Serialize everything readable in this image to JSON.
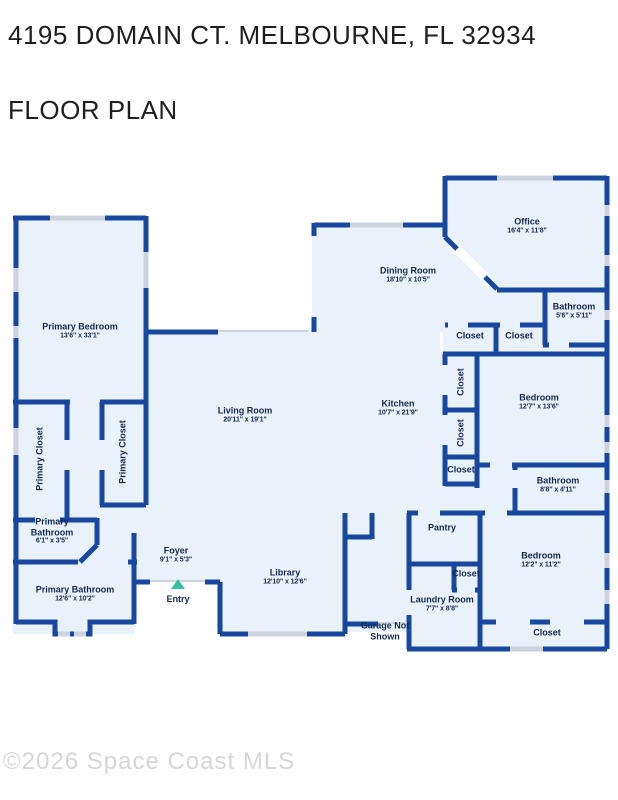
{
  "page": {
    "address_title": "4195 DOMAIN CT. MELBOURNE, FL 32934",
    "subtitle": "FLOOR PLAN",
    "watermark": "©2026 Space Coast MLS"
  },
  "floorplan": {
    "entry_label": "Entry",
    "garage_note": "Garage Not Shown",
    "colors": {
      "wall": "#17479e",
      "room_fill": "#e9f2fb",
      "window": "#ccd3dc",
      "label": "#14284b",
      "entry": "#35c0a2"
    },
    "rooms": [
      {
        "name": "Primary Bedroom",
        "dims": "13'6\" x 33'1\"",
        "x": 80,
        "y": 331
      },
      {
        "name": "Primary Closet",
        "dims": "",
        "x": 40,
        "y": 459,
        "vertical": true
      },
      {
        "name": "Primary Closet",
        "dims": "",
        "x": 123,
        "y": 452,
        "vertical": true
      },
      {
        "name": "Primary Bathroom",
        "dims": "6'1\" x 3'5\"",
        "x": 52,
        "y": 531,
        "wrap": true,
        "w": 58
      },
      {
        "name": "Primary Bathroom",
        "dims": "12'6\" x 10'2\"",
        "x": 75,
        "y": 594
      },
      {
        "name": "Foyer",
        "dims": "9'1\" x 5'3\"",
        "x": 176,
        "y": 555
      },
      {
        "name": "Living Room",
        "dims": "20'11\" x 19'1\"",
        "x": 245,
        "y": 415
      },
      {
        "name": "Library",
        "dims": "12'10\" x 12'6\"",
        "x": 285,
        "y": 577
      },
      {
        "name": "Dining Room",
        "dims": "18'10\" x 10'5\"",
        "x": 408,
        "y": 275
      },
      {
        "name": "Kitchen",
        "dims": "10'7\" x 21'9\"",
        "x": 398,
        "y": 408
      },
      {
        "name": "Office",
        "dims": "16'4\" x 11'8\"",
        "x": 527,
        "y": 226
      },
      {
        "name": "Bathroom",
        "dims": "5'6\" x 5'11\"",
        "x": 574,
        "y": 311
      },
      {
        "name": "Closet",
        "dims": "",
        "x": 470,
        "y": 336
      },
      {
        "name": "Closet",
        "dims": "",
        "x": 519,
        "y": 336
      },
      {
        "name": "Closet",
        "dims": "",
        "x": 461,
        "y": 382,
        "vertical": true
      },
      {
        "name": "Closet",
        "dims": "",
        "x": 461,
        "y": 433,
        "vertical": true
      },
      {
        "name": "Closet",
        "dims": "",
        "x": 461,
        "y": 470
      },
      {
        "name": "Bedroom",
        "dims": "12'7\" x 13'6\"",
        "x": 539,
        "y": 402
      },
      {
        "name": "Bathroom",
        "dims": "8'8\" x 4'11\"",
        "x": 558,
        "y": 485
      },
      {
        "name": "Pantry",
        "dims": "",
        "x": 442,
        "y": 528
      },
      {
        "name": "Closet",
        "dims": "",
        "x": 466,
        "y": 574
      },
      {
        "name": "Bedroom",
        "dims": "12'2\" x 11'2\"",
        "x": 541,
        "y": 560
      },
      {
        "name": "Laundry Room",
        "dims": "7'7\" x 8'8\"",
        "x": 442,
        "y": 604
      },
      {
        "name": "Closet",
        "dims": "",
        "x": 547,
        "y": 633
      },
      {
        "name": "Garage Not Shown",
        "dims": "",
        "x": 385,
        "y": 631,
        "wrap": true,
        "w": 60
      }
    ]
  }
}
